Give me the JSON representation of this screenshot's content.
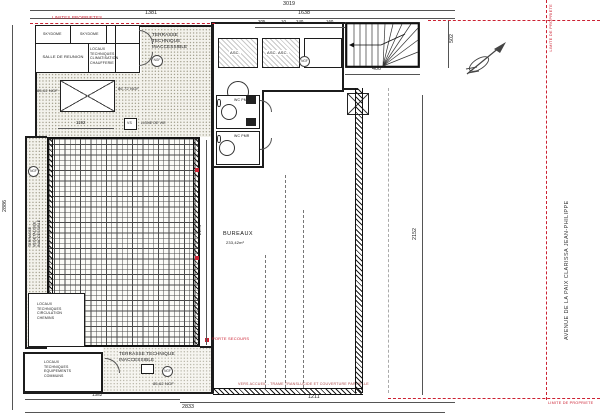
{
  "plan": {
    "street": "AVENUE DE LA PAIX   CLARISSA JEAN-PHILIPPE",
    "bureaux_name": "BUREAUX",
    "bureaux_area": "233,42m²",
    "terrasse_top": "TERRASSE\nTECHNIQUE\nINACCESSIBLE",
    "terrasse_left": "TERRASSE\nVEGETALISEE\nINACCESSIBLE",
    "terrasse_bottom": "TERRASSE TECHNIQUE\nINACCESSIBLE",
    "salle": "SALLE DE REUNION",
    "locaux_top": "LOCAUX\nTECHNIQUES\nCLIMATISATION\nCHAUFFERIE",
    "locaux_mid": "LOCAUX\nTECHNIQUES\nCIRCULATION\nCHEMINS",
    "locaux_bottom": "LOCAUX\nTECHNIQUES\nEQUIPEMENTS\nCOMMUNS",
    "skydome_1": "SKYDOME",
    "skydome_2": "SKYDOME",
    "asc_1": "ASC.",
    "asc_2": "ASC. ASC.",
    "wc_1": "WC PMR",
    "wc_2": "WC PMR",
    "vs": "VS",
    "ligne_de_vie": "LIGNE DE VIE",
    "ngf_top": "86,72 NGF",
    "ngf_left": "85,02 NGF",
    "ngf_bottom": "85,62 NGF",
    "marker_text": "NGF"
  },
  "boundary": {
    "top": "LIMITES PROPRIETES",
    "right": "LIMITE DE PROPRIETE",
    "bottom": "LIMITE DE PROPRIETE",
    "color": "#c23"
  },
  "dims": {
    "overall_top": "3019",
    "top_a": "1381",
    "top_b": "1638",
    "left": "2886",
    "right_top": "502",
    "right_side": "2152",
    "stair_w": "400",
    "core_a": "205",
    "core_b": "10",
    "core_c": "240",
    "core_d": "160",
    "grid_h": "2174",
    "skylight": "1192",
    "bottom_room": "1382",
    "bottom_a": "2833",
    "bottom_b": "1211"
  },
  "notes": {
    "porte_secours": "PORTE SECOURS",
    "bottom_note": "VERS ACCUEIL - TRAME TRANSLUCIDE ET COUVERTURE PARTIELLE"
  }
}
